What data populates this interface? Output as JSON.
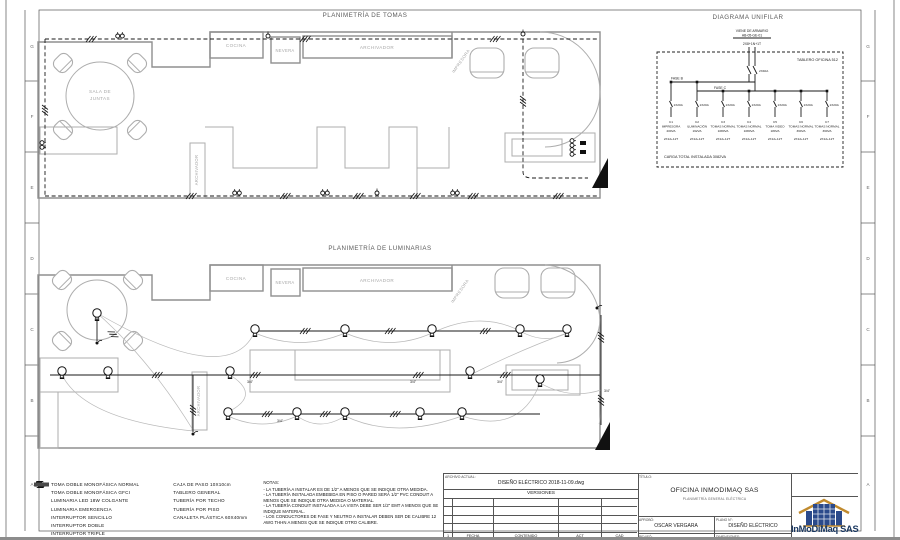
{
  "sheet": {
    "row_letters": [
      "G",
      "F",
      "E",
      "D",
      "C",
      "B",
      "A"
    ]
  },
  "titles": {
    "tomas": "PLANIMETRÍA DE TOMAS",
    "luminarias": "PLANIMETRÍA DE LUMINARIAS",
    "unifilar": "DIAGRAMA UNIFILAR"
  },
  "plan_tomas": {
    "sala_line1": "SALA DE",
    "sala_line2": "JUNTAS",
    "cocina": "COCINA",
    "nevera": "NEVERA",
    "archivador": "ARCHIVADOR",
    "archivador_vertical": "ARCHIVADOR",
    "impresora": "IMPRESORA"
  },
  "plan_luminarias": {
    "cocina": "COCINA",
    "nevera": "NEVERA",
    "archivador": "ARCHIVADOR",
    "archivador_vertical": "ARCHIVADOR",
    "impresora": "IMPRESORA",
    "conduit_size": "3/4\""
  },
  "unifilar": {
    "feeder_line1": "VIENE DE ARMARIO",
    "feeder_line2": "AB-05-GE-01",
    "feeder_cable": "2X8+1N+1T",
    "main_breaker": "2X40A",
    "panel": "TABLERO OFICINA 512",
    "fase_b": "FASE B",
    "fase_c": "FASE C",
    "total": "CARGA TOTAL INSTALADA 3082VA",
    "circuits": [
      {
        "breaker": "1X20A",
        "id": "C1",
        "name": "IMPRESORA",
        "load": "200VA",
        "cable": "2X12+12T"
      },
      {
        "breaker": "1X20A",
        "id": "C2",
        "name": "ILUMINACIÓN",
        "load": "162VA",
        "cable": "2X12+12T"
      },
      {
        "breaker": "1X20A",
        "id": "C3",
        "name": "TOMAS NORMAL",
        "load": "1080VA",
        "cable": "2X12+12T"
      },
      {
        "breaker": "1X20A",
        "id": "C4",
        "name": "TOMAS NORMAL",
        "load": "1080VA",
        "cable": "2X12+12T"
      },
      {
        "breaker": "1X20A",
        "id": "C5",
        "name": "TOMA VIDEO",
        "load": "180VA",
        "cable": "2X12+12T"
      },
      {
        "breaker": "1X20A",
        "id": "C6",
        "name": "TOMAS NORMAL",
        "load": "360VA",
        "cable": "2X12+12T"
      },
      {
        "breaker": "1X20A",
        "id": "C7",
        "name": "TOMAS NORMAL",
        "load": "360VA",
        "cable": "2X12+12T"
      }
    ]
  },
  "legend": {
    "col1": [
      {
        "label": "TOMA DOBLE MONOFÁSICA NORMAL"
      },
      {
        "label": "TOMA DOBLE MONOFÁSICA GFCI"
      },
      {
        "label": "LUMINARIA LED 18W COLGANTE"
      },
      {
        "label": "LUMINARIA EMERGENCIA"
      },
      {
        "label": "INTERRUPTOR SENCILLO"
      },
      {
        "label": "INTERRUPTOR DOBLE"
      },
      {
        "label": "INTERRUPTOR TRIPLE"
      }
    ],
    "col2": [
      {
        "label": "CAJA DE PASO 10X10cm"
      },
      {
        "label": "TABLERO GENERAL"
      },
      {
        "label": "TUBERÍA POR TECHO"
      },
      {
        "label": "TUBERÍA POR PISO"
      },
      {
        "label": "CANALETA PLÁSTICA 60X40mm"
      }
    ],
    "notes_title": "NOTAS:",
    "notes": [
      "- LA TUBERÍA A INSTALAR ES DE 1/2\" A MENOS QUE SE INDIQUE OTRA MEDIDA.",
      "- LA TUBERÍA INSTALADA EMBEBIDA EN PISO O PARED SERÁ 1/2\" PVC CONDUIT A MENOS QUE SE INDIQUE OTRA MEDIDA O MATERIAL.",
      "- LA TUBERÍA CONDUIT INSTALADA A LA VISTA DEBE SER 1/2\" EMT A MENOS QUE SE INDIQUE MATERIAL.",
      "- LOS CONDUCTORES DE FASE Y NEUTRO A INSTALAR DEBEN SER DE CALIBRE 12 AWG THHN A MENOS QUE SE INDIQUE OTRO CALIBRE."
    ]
  },
  "titleblock": {
    "archivo_label": "ARCHIVO ACTUAL:",
    "archivo": "DISEÑO ELÉCTRICO 2018-11-09.dwg",
    "versiones": "VERSIONES",
    "version_cols": [
      "1",
      "FECHA",
      "CONTENIDO",
      "ACT",
      "CAD"
    ],
    "titulo_label": "TÍTULO:",
    "titulo": "OFICINA INMODIMAQ SAS",
    "subtitulo": "PLANIMETRÍA GENERAL ELÉCTRICA",
    "aprobo_label": "APROBÓ:",
    "aprobo": "OSCAR VERGARA",
    "plano_label": "PLANO N°:",
    "plano": "DISEÑO ELÉCTRICO",
    "reviso_label": "REVISÓ:",
    "reviso": "OSCAR VERGARA",
    "dimensiones_label": "DIMENSIONES:",
    "dimensiones": ""
  },
  "logo": {
    "name": "InMoDiMaq SAS",
    "navy": "#17355e",
    "blue": "#2b4a8b",
    "gold": "#c08a2e"
  }
}
